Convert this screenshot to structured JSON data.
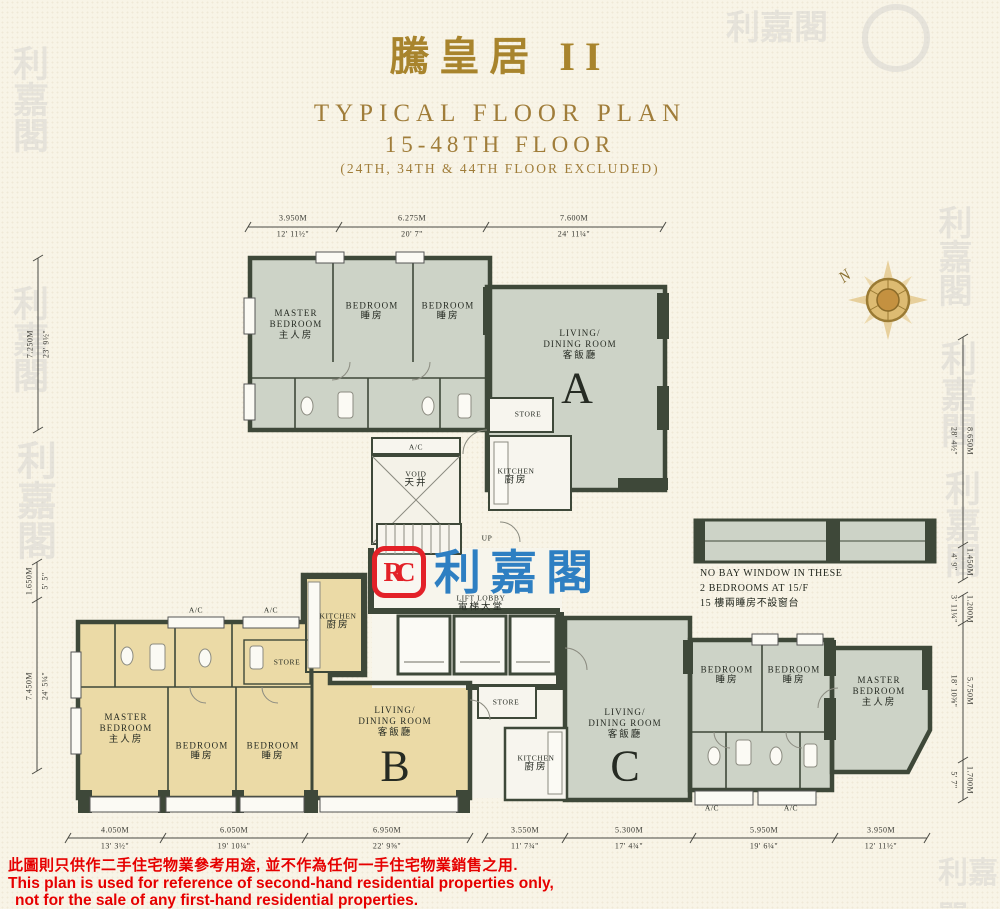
{
  "title": {
    "zh": "騰皇居 II",
    "en1": "TYPICAL FLOOR PLAN",
    "en2": "15-48TH FLOOR",
    "en3": "(24TH, 34TH & 44TH FLOOR EXCLUDED)"
  },
  "compass": {
    "n": "N"
  },
  "logo": {
    "monogram": "RC",
    "name": "利嘉閣"
  },
  "watermark": {
    "chars": "利嘉閣"
  },
  "units": {
    "a": "A",
    "b": "B",
    "c": "C"
  },
  "rooms": {
    "master_bedroom": {
      "en1": "MASTER",
      "en2": "BEDROOM",
      "zh": "主人房"
    },
    "bedroom": {
      "en": "BEDROOM",
      "zh": "睡房"
    },
    "living": {
      "en1": "LIVING/",
      "en2": "DINING ROOM",
      "zh": "客飯廳"
    },
    "kitchen": {
      "en": "KITCHEN",
      "zh": "廚房"
    },
    "store": {
      "en": "STORE"
    },
    "void": {
      "en": "VOID",
      "zh": "天井"
    },
    "lift_lobby": {
      "en": "LIFT LOBBY",
      "zh": "電梯大堂"
    },
    "ac": {
      "en": "A/C"
    },
    "up": {
      "en": "UP"
    }
  },
  "note": {
    "l1": "NO BAY WINDOW IN THESE",
    "l2": "2 BEDROOMS AT 15/F",
    "l3": "15 樓兩睡房不設窗台"
  },
  "dims": {
    "top": [
      {
        "m": "3.950M",
        "ft": "12' 11½\""
      },
      {
        "m": "6.275M",
        "ft": "20' 7\""
      },
      {
        "m": "7.600M",
        "ft": "24' 11¼\""
      }
    ],
    "bottom": [
      {
        "m": "4.050M",
        "ft": "13' 3½\""
      },
      {
        "m": "6.050M",
        "ft": "19' 10¼\""
      },
      {
        "m": "6.950M",
        "ft": "22' 9⅝\""
      },
      {
        "m": "3.550M",
        "ft": "11' 7¾\""
      },
      {
        "m": "5.300M",
        "ft": "17' 4¾\""
      },
      {
        "m": "5.950M",
        "ft": "19' 6¼\""
      },
      {
        "m": "3.950M",
        "ft": "12' 11½\""
      }
    ],
    "left": [
      {
        "m": "7.250M",
        "ft": "23' 9½\""
      },
      {
        "m": "1.650M",
        "ft": "5' 5\""
      },
      {
        "m": "7.450M",
        "ft": "24' 5¼\""
      }
    ],
    "right": [
      {
        "m": "8.650M",
        "ft": "28' 4½\""
      },
      {
        "m": "1.450M",
        "ft": "4' 9\""
      },
      {
        "m": "1.200M",
        "ft": "3' 11¼\""
      },
      {
        "m": "5.750M",
        "ft": "18' 10⅜\""
      },
      {
        "m": "1.700M",
        "ft": "5' 7\""
      }
    ]
  },
  "disclaimer": {
    "zh": "此圖則只供作二手住宅物業參考用途, 並不作為任何一手住宅物業銷售之用.",
    "en1": "This plan is used for reference of second-hand residential properties only,",
    "en2": "not for the sale of any first-hand residential properties."
  },
  "colors": {
    "background": "#f8f4e7",
    "title_gold": "#a8842d",
    "wall_dark": "#3e4839",
    "unit_a_c_floor": "#cdd3c7",
    "unit_b_floor": "#ebdaa6",
    "logo_red": "#e32128",
    "logo_blue": "#2e7fc2",
    "disclaimer_red": "#e60000",
    "compass_gold": "#c49140"
  }
}
